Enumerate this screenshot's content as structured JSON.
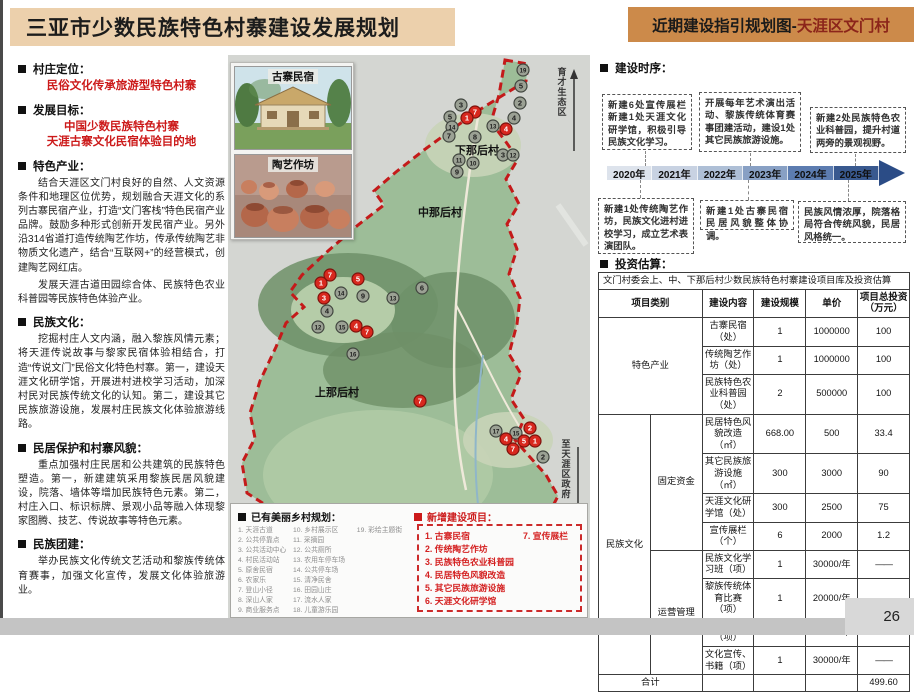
{
  "page": {
    "number": "26"
  },
  "colors": {
    "header_tan": "#ecd0ac",
    "header_orange": "#cc8a4a",
    "accent_red": "#cc1a1a",
    "timeline_segments": [
      "#dde3ec",
      "#c8d2e2",
      "#aebfd6",
      "#88a0c4",
      "#5c7cb0",
      "#39598f"
    ],
    "marker_existing": "#9ba194",
    "marker_new": "#d8281e"
  },
  "header": {
    "left_title": "三亚市少数民族特色村寨建设发展规划",
    "right_title_prefix": "近期建设指引规划图-",
    "right_title_highlight": "天涯区文门村"
  },
  "left_panel": {
    "sections": [
      {
        "heading": "村庄定位：",
        "red_lines": [
          "民俗文化传承旅游型特色村寨"
        ],
        "paragraphs": []
      },
      {
        "heading": "发展目标：",
        "red_lines": [
          "中国少数民族特色村寨",
          "天涯古寨文化民宿体验目的地"
        ],
        "paragraphs": []
      },
      {
        "heading": "特色产业：",
        "red_lines": [],
        "paragraphs": [
          "结合天涯区文门村良好的自然、人文资源条件和地理区位优势，规划融合天涯文化的系列古寨民宿产业，打造“文门客栈”特色民宿产业品牌。鼓励多种形式创新开发民宿产业。另外沿314省道打造传统陶艺作坊，传承传统陶艺非物质文化遗产，结合“互联网+”的经营模式，创建陶艺网红店。",
          "发展天涯古道田园综合体、民族特色农业科普园等民族特色体验产业。"
        ]
      },
      {
        "heading": "民族文化：",
        "red_lines": [],
        "paragraphs": [
          "挖掘村庄人文内涵，融入黎族风情元素；将天涯传说故事与黎家民宿体验相结合，打造“传说文门”民俗文化特色村寨。第一，建设天涯文化研学馆，开展进村进校学习活动，加深村民对民族传统文化的认知。第二，建设其它民族旅游设施，发展村庄民族文化体验旅游线路。"
        ]
      },
      {
        "heading": "民居保护和村寨风貌：",
        "red_lines": [],
        "paragraphs": [
          "重点加强村庄民居和公共建筑的民族特色塑造。第一，新建建筑采用黎族民居风貌建设，院落、墙体等增加民族特色元素。第二，村庄入口、标识标牌、景观小品等融入体现黎家图腾、技艺、传说故事等特色元素。"
        ]
      },
      {
        "heading": "民族团建：",
        "red_lines": [],
        "paragraphs": [
          "举办民族文化传统文艺活动和黎族传统体育赛事，加强文化宣传，发展文化体验旅游业。"
        ]
      }
    ]
  },
  "map": {
    "photos": [
      {
        "label": "古寨民宿"
      },
      {
        "label": "陶艺作坊"
      }
    ],
    "village_labels": [
      {
        "text": "下那后村",
        "x": 249,
        "y": 99
      },
      {
        "text": "中那后村",
        "x": 212,
        "y": 161
      },
      {
        "text": "上那后村",
        "x": 109,
        "y": 341
      }
    ],
    "road_labels": [
      {
        "text": "育才生态区",
        "direction": "up"
      },
      {
        "text": "至天涯区政府",
        "direction": "down"
      }
    ],
    "markers": {
      "existing": [
        [
          "19",
          295,
          15
        ],
        [
          "5",
          293,
          31
        ],
        [
          "2",
          292,
          48
        ],
        [
          "3",
          233,
          50
        ],
        [
          "5",
          222,
          62
        ],
        [
          "14",
          224,
          72
        ],
        [
          "4",
          286,
          63
        ],
        [
          "13",
          265,
          71
        ],
        [
          "7",
          221,
          81
        ],
        [
          "8",
          247,
          82
        ],
        [
          "3",
          275,
          100
        ],
        [
          "12",
          285,
          100
        ],
        [
          "11",
          231,
          105
        ],
        [
          "10",
          245,
          108
        ],
        [
          "9",
          229,
          117
        ],
        [
          "6",
          194,
          233
        ],
        [
          "14",
          113,
          238
        ],
        [
          "9",
          135,
          241
        ],
        [
          "13",
          165,
          243
        ],
        [
          "4",
          99,
          256
        ],
        [
          "12",
          90,
          272
        ],
        [
          "15",
          114,
          272
        ],
        [
          "16",
          125,
          299
        ],
        [
          "17",
          268,
          376
        ],
        [
          "15",
          288,
          378
        ],
        [
          "2",
          315,
          402
        ]
      ],
      "new": [
        [
          "7",
          247,
          57
        ],
        [
          "1",
          239,
          63
        ],
        [
          "4",
          278,
          74
        ],
        [
          "7",
          102,
          220
        ],
        [
          "1",
          93,
          228
        ],
        [
          "5",
          130,
          224
        ],
        [
          "3",
          96,
          243
        ],
        [
          "4",
          128,
          271
        ],
        [
          "7",
          139,
          277
        ],
        [
          "7",
          192,
          346
        ],
        [
          "2",
          302,
          373
        ],
        [
          "4",
          278,
          384
        ],
        [
          "5",
          296,
          386
        ],
        [
          "1",
          307,
          386
        ],
        [
          "7",
          285,
          394
        ]
      ]
    },
    "legend": {
      "existing_title": "已有美丽乡村规划：",
      "existing_cols": [
        [
          "1.  天涯古道",
          "2.  公共停靠点",
          "3.  公共活动中心",
          "4.  村民活动站",
          "5.  原舍民宿",
          "6.  农家乐",
          "7.  登山小径",
          "8.  深山人家",
          "9.  商业服务点"
        ],
        [
          "10. 乡村展示区",
          "11. 采摘园",
          "12. 公共厕所",
          "13. 农用车停车场",
          "14. 公共停车场",
          "15. 清净民舍",
          "16. 田园山庄",
          "17. 流水人家",
          "18. 儿童游乐园"
        ],
        [
          "19. 彩绘主题街"
        ]
      ],
      "new_title": "新增建设项目：",
      "new_cols": [
        [
          "1.  古寨民宿",
          "2.  传统陶艺作坊",
          "3.  民族特色农业科普园",
          "4.  民居特色风貌改造",
          "5.  其它民族旅游设施",
          "6.  天涯文化研学馆"
        ],
        [
          "7.  宣传展栏"
        ]
      ]
    }
  },
  "timeline": {
    "heading": "建设时序：",
    "years": [
      "2020年",
      "2021年",
      "2022年",
      "2023年",
      "2024年",
      "2025年"
    ],
    "boxes_top": [
      "新建6处宣传展栏 新建1处天涯文化研学馆，积极引导民族文化学习。",
      "开展每年艺术演出活动、黎族传统体育赛事团建活动，建设1处其它民族旅游设施。",
      "新建2处民族特色农业科普园，提升村道两旁的景观视野。"
    ],
    "boxes_bottom": [
      "新建1处传统陶艺作坊，民族文化进村进校学习，成立艺术表演团队。",
      "新建1处古寨民宿 民居风貌整体协调。",
      "民族风情浓厚，院落格局符合传统风貌，民居风格统一。"
    ]
  },
  "investment": {
    "heading": "投资估算：",
    "table_title": "文门村委会上、中、下那后村少数民族特色村寨建设项目库及投资估算",
    "columns": [
      "项目类别",
      "建设内容",
      "建设规模",
      "单价",
      "项目总投资（万元）"
    ],
    "rows": [
      {
        "cat": {
          "label": "特色产业",
          "rowspan": 3,
          "colspan": 2
        },
        "content": "古寨民宿（处）",
        "scale": "1",
        "price": "1000000",
        "total": "100"
      },
      {
        "content": "传统陶艺作坊（处）",
        "scale": "1",
        "price": "1000000",
        "total": "100"
      },
      {
        "content": "民族特色农业科普园（处）",
        "scale": "2",
        "price": "500000",
        "total": "100"
      },
      {
        "cat": {
          "label": "民族文化",
          "rowspan": 8,
          "colspan": 1
        },
        "sub": {
          "label": "固定资金",
          "rowspan": 4
        },
        "content": "民居特色风貌改造（㎡）",
        "scale": "668.00",
        "price": "500",
        "total": "33.4"
      },
      {
        "content": "其它民族旅游设施（㎡）",
        "scale": "300",
        "price": "3000",
        "total": "90"
      },
      {
        "content": "天涯文化研学馆（处）",
        "scale": "300",
        "price": "2500",
        "total": "75"
      },
      {
        "content": "宣传展栏（个）",
        "scale": "6",
        "price": "2000",
        "total": "1.2"
      },
      {
        "sub": {
          "label": "运营管理",
          "rowspan": 4
        },
        "content": "民族文化学习班（项）",
        "scale": "1",
        "price": "30000/年",
        "total": "——"
      },
      {
        "content": "黎族传统体育比赛（项）",
        "scale": "1",
        "price": "20000/年",
        "total": "——"
      },
      {
        "content": "艺术表演（项）",
        "scale": "1",
        "price": "20000/年",
        "total": "——"
      },
      {
        "content": "文化宣传、书籍（项）",
        "scale": "1",
        "price": "30000/年",
        "total": "——"
      }
    ],
    "total_row": {
      "label": "合计",
      "total": "499.60"
    }
  }
}
